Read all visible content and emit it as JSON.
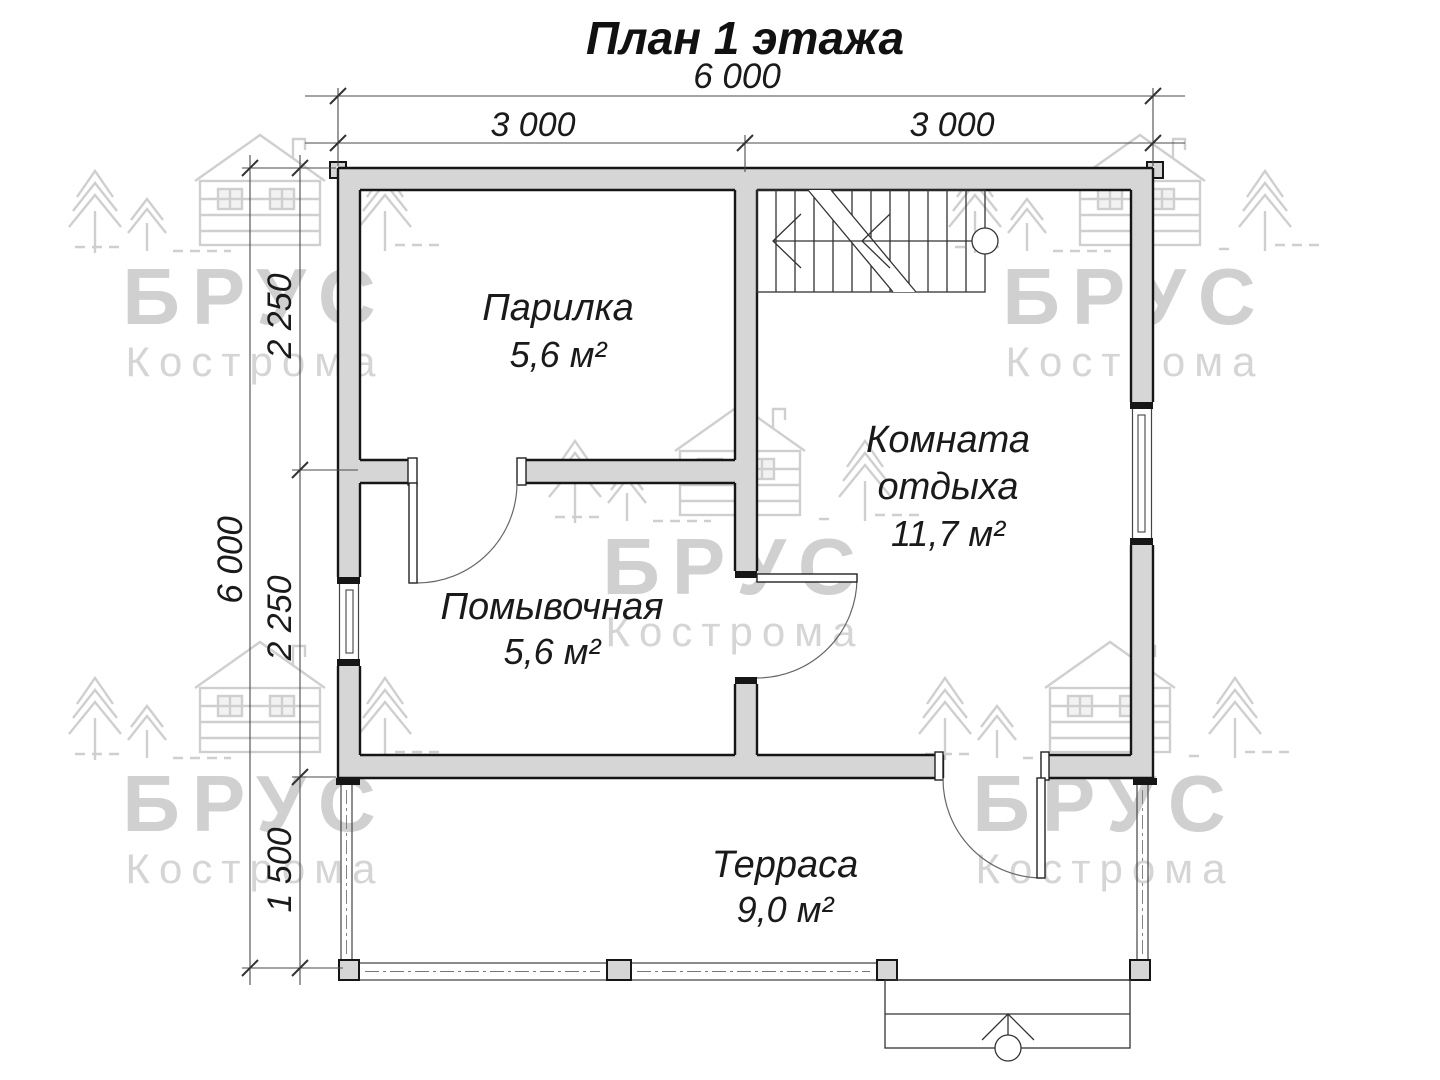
{
  "title": "План 1 этажа",
  "dims": {
    "total_width": "6 000",
    "left_half": "3 000",
    "right_half": "3 000",
    "total_height": "6 000",
    "seg_top": "2 250",
    "seg_mid": "2 250",
    "seg_bottom": "1 500"
  },
  "rooms": {
    "parilka": {
      "name": "Парилка",
      "area": "5,6 м²"
    },
    "komnata": {
      "name_line1": "Комната",
      "name_line2": "отдыха",
      "area": "11,7 м²"
    },
    "pomyvochnaya": {
      "name": "Помывочная",
      "area": "5,6 м²"
    },
    "terrasa": {
      "name": "Терраса",
      "area": "9,0 м²"
    }
  },
  "watermark": {
    "brand": "БРУС",
    "city": "Кострома"
  },
  "colors": {
    "wall_fill": "#d6d6d6",
    "outline": "#161616",
    "thin_line": "#444444",
    "dim_line": "#4a4a4a",
    "watermark_text": "#d0d0d0",
    "background": "#ffffff"
  }
}
